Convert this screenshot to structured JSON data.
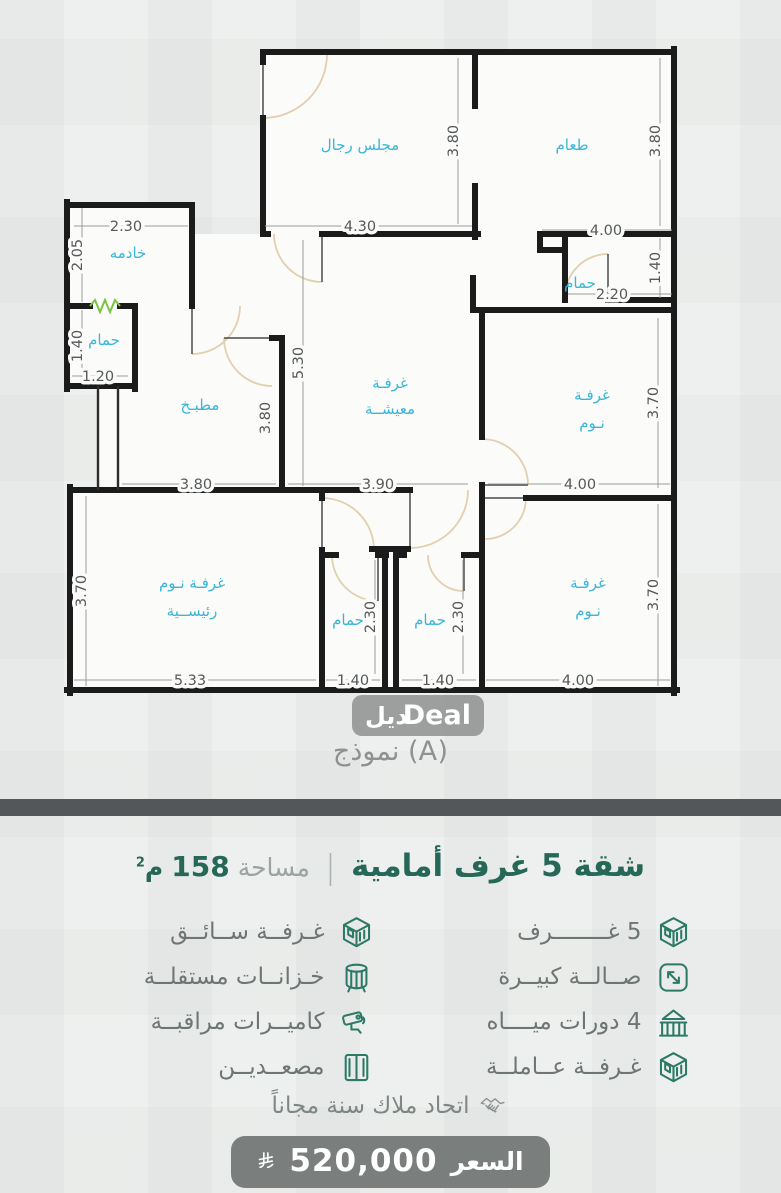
{
  "colors": {
    "accent_teal": "#266858",
    "icon_teal": "#2c7a66",
    "room_label_cyan": "#38b6d7",
    "dim_text": "#55595a",
    "feature_text": "#6d7674",
    "divider_gray": "#54575a",
    "price_pill_gray": "#7a7e7d",
    "window_green": "#7cc242"
  },
  "plan": {
    "model_label": "نموذج (A)",
    "watermark": {
      "arabic": "ديل",
      "latin": "Deal"
    },
    "rooms": {
      "majlis": "مجلس رجال",
      "dining": "طعام",
      "maid": "خادمه",
      "bath": "حمام",
      "kitchen": "مطبـخ",
      "living_line1": "غرفـة",
      "living_line2": "معيشــة",
      "bedroom_line1": "غرفـة",
      "bedroom_line2": "نـوم",
      "master_line1": "غرفـة نـوم",
      "master_line2": "رئيســية"
    },
    "dims": {
      "v430": "4.30",
      "v400": "4.00",
      "v390": "3.90",
      "v380": "3.80",
      "v370": "3.70",
      "v533": "5.33",
      "v530": "5.30",
      "v230": "2.30",
      "v220": "2.20",
      "v205": "2.05",
      "v140": "1.40",
      "v120": "1.20"
    }
  },
  "info": {
    "title": "شقة 5 غرف أمامية",
    "separator": "|",
    "area_label": "مساحة",
    "area_value": "158",
    "area_unit": "م",
    "area_sup": "2",
    "features": [
      {
        "label": "5 غــــــــرف",
        "icon": "cube-building-icon"
      },
      {
        "label": "غـرفــة ســائــق",
        "icon": "cube-building-icon"
      },
      {
        "label": "صــالــة كبيــرة",
        "icon": "expand-arrows-icon"
      },
      {
        "label": "خـزانــات مستقلــة",
        "icon": "water-tank-icon"
      },
      {
        "label": "4 دورات ميــــاه",
        "icon": "bathhouse-icon"
      },
      {
        "label": "كاميــرات مراقبــة",
        "icon": "cctv-camera-icon"
      },
      {
        "label": "غـرفــة عــاملــة",
        "icon": "cube-building-icon"
      },
      {
        "label": "مصعــديــن",
        "icon": "elevator-icon"
      }
    ],
    "bonus": {
      "label": "اتحاد ملاك سنة مجاناً",
      "icon": "handshake-icon"
    },
    "price": {
      "label": "السعر",
      "value": "520,000",
      "currency_icon": "saudi-riyal-symbol"
    }
  }
}
